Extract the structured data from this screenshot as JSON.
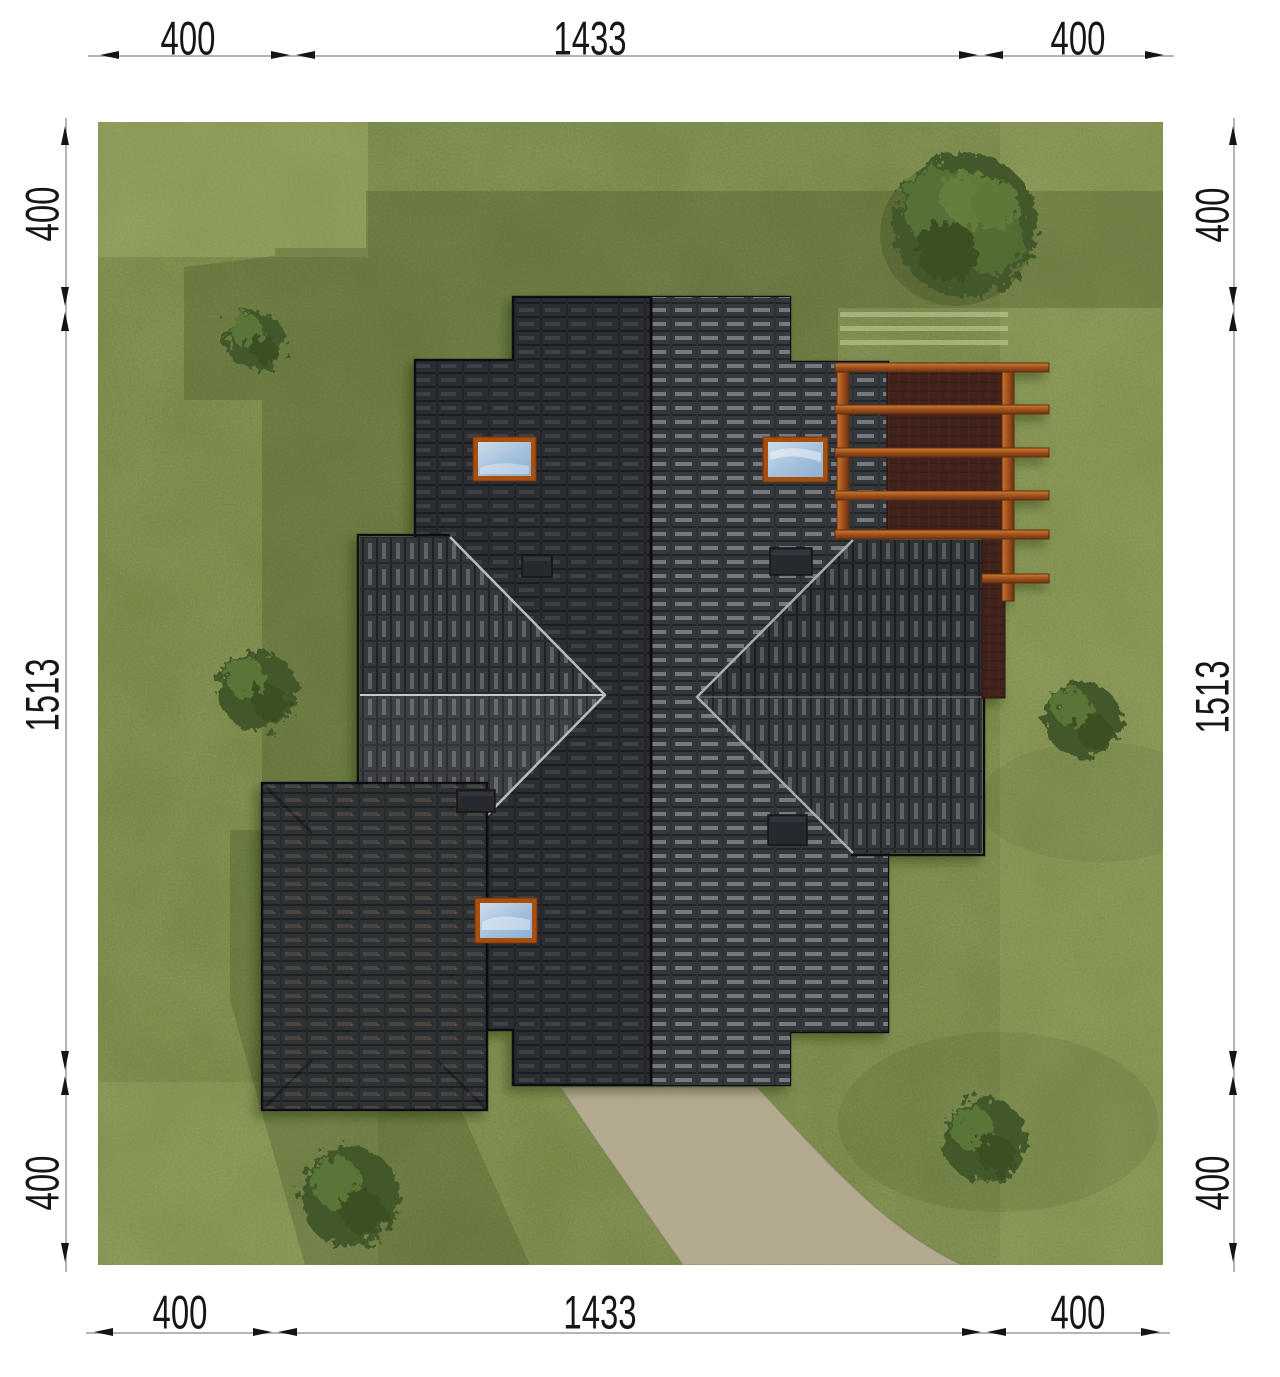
{
  "page": {
    "type": "architectural-site-plan-top-view",
    "background": "#ffffff"
  },
  "dimensions": {
    "top": {
      "segments": [
        "400",
        "1433",
        "400"
      ]
    },
    "bottom": {
      "segments": [
        "400",
        "1433",
        "400"
      ]
    },
    "left": {
      "segments": [
        "400",
        "1513",
        "400"
      ]
    },
    "right": {
      "segments": [
        "400",
        "1513",
        "400"
      ]
    },
    "style": {
      "line_color": "#b4b4b4",
      "arrow_color": "#141414",
      "text_color": "#161616"
    }
  },
  "scene": {
    "grass_color": "#7e8e4e",
    "shade_color": "#2c3c17",
    "roof_dark_slope": "#2c2f33",
    "roof_light_slope": "#35393d",
    "roof_wing_slope": "#33373b",
    "roof_ridge_color": "#0b0d0f",
    "hip_line_color": "#b9bcbe",
    "pergola_wood_color": "#b4612b",
    "deck_color": "#42241c",
    "driveway_color": "#b3a98e",
    "skylight_frame_color": "#a8500e",
    "skylight_glass_color": "#a9c2dd",
    "chimney_color": "#26292d",
    "tree_color": "#42582a",
    "skylight_count": 3,
    "chimney_count": 4,
    "bush_count": 5,
    "tree_count": 1,
    "pergola_beam_count": 6
  }
}
